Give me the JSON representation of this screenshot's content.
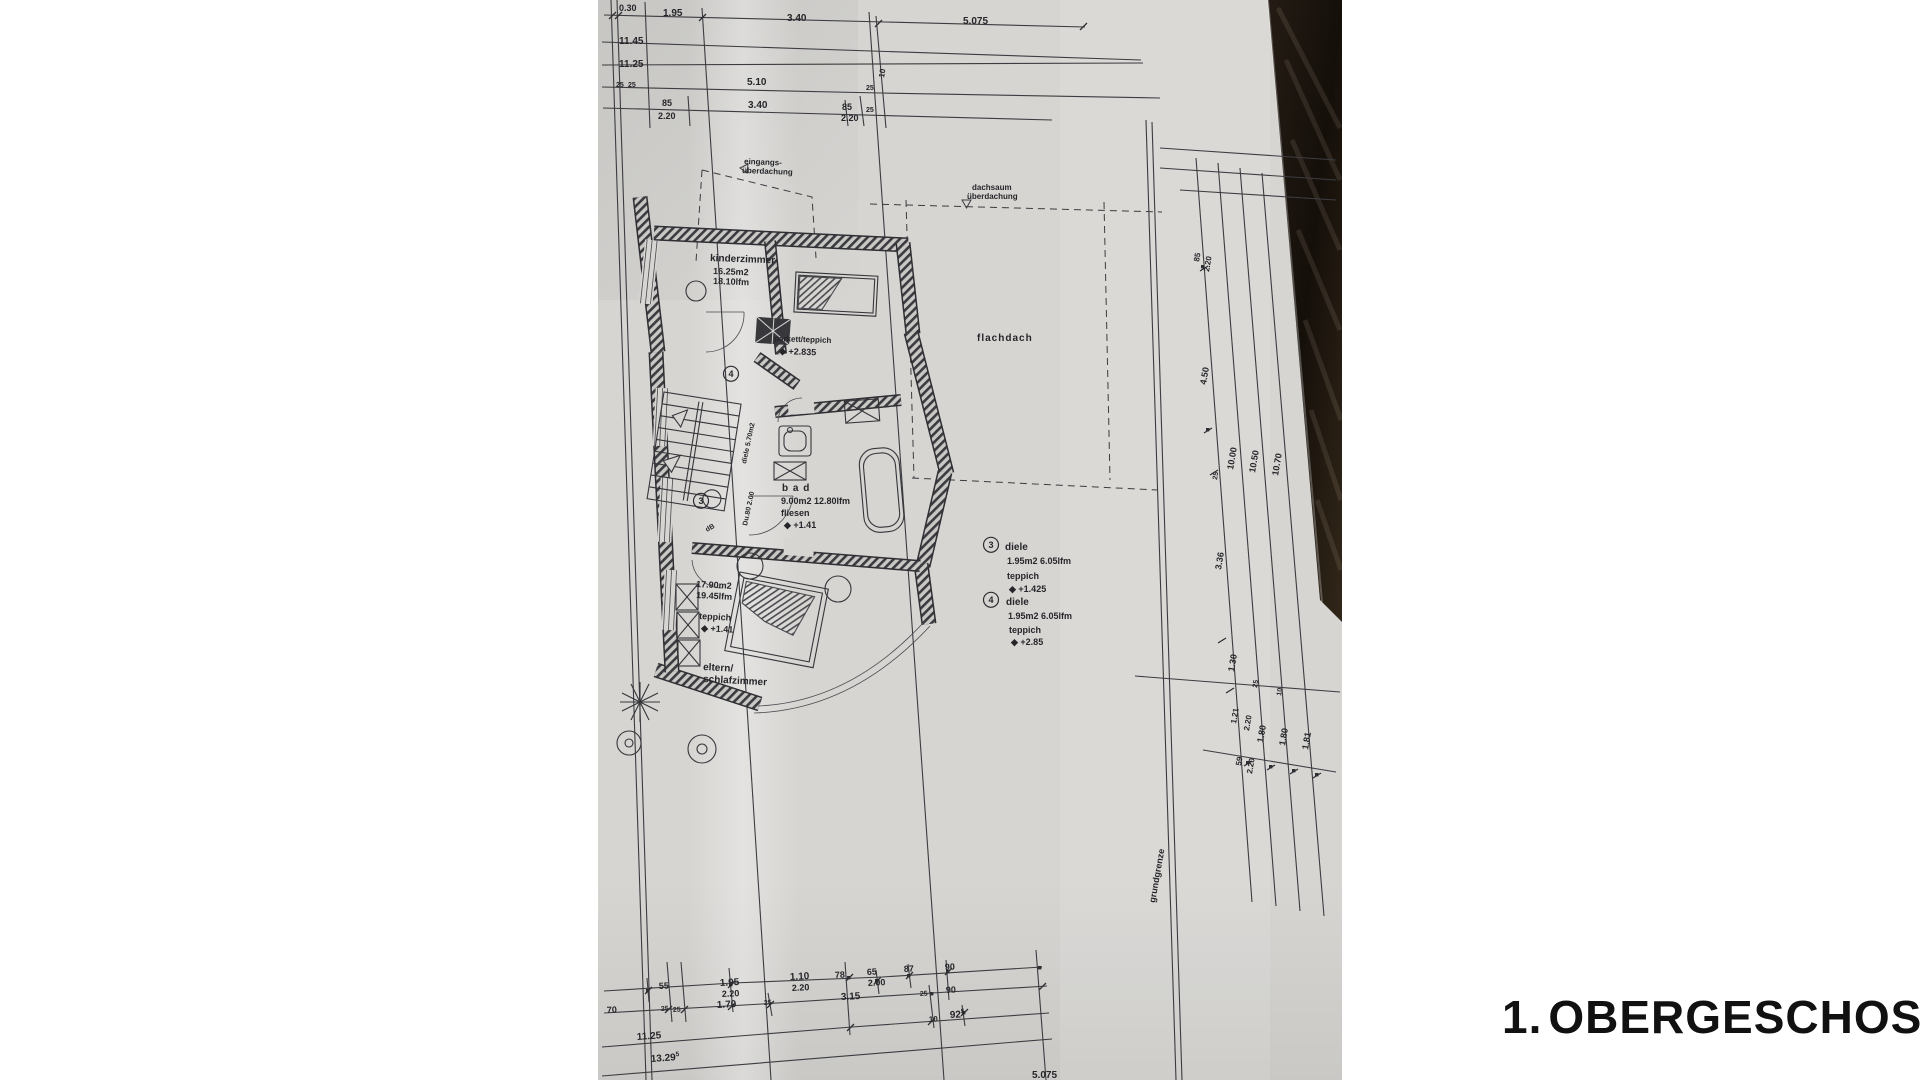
{
  "title": {
    "prefix": "1.",
    "name": "OBERGESCHOSS"
  },
  "colors": {
    "paper": "#d6d5d2",
    "line": "#3c3c41",
    "wood_dark": "#17120d",
    "wood_light": "#3a2f25",
    "title": "#111111"
  },
  "plan": {
    "labels": [
      {
        "id": "dim-030",
        "t": "0.30",
        "x": 619,
        "y": 11,
        "s": 9
      },
      {
        "id": "dim-195",
        "t": "1.95",
        "x": 663,
        "y": 16,
        "s": 10
      },
      {
        "id": "dim-340a",
        "t": "3.40",
        "x": 787,
        "y": 21,
        "s": 10
      },
      {
        "id": "dim-5075",
        "t": "5.075",
        "x": 963,
        "y": 24,
        "s": 10
      },
      {
        "id": "dim-1145",
        "t": "11.45",
        "x": 619,
        "y": 44,
        "s": 10
      },
      {
        "id": "dim-1125",
        "t": "11.25",
        "x": 619,
        "y": 67,
        "s": 10
      },
      {
        "id": "dim-510",
        "t": "5.10",
        "x": 747,
        "y": 85,
        "s": 10
      },
      {
        "id": "dim-10a",
        "t": "10",
        "x": 884,
        "y": 78,
        "s": 8,
        "r": -80
      },
      {
        "id": "dim-25a",
        "t": "25",
        "x": 866,
        "y": 90,
        "s": 7
      },
      {
        "id": "dim-25b",
        "t": "25",
        "x": 616,
        "y": 87,
        "s": 7
      },
      {
        "id": "dim-25c",
        "t": "25",
        "x": 628,
        "y": 87,
        "s": 7
      },
      {
        "id": "dim-85a",
        "t": "85",
        "x": 662,
        "y": 106,
        "s": 9
      },
      {
        "id": "dim-340b",
        "t": "3.40",
        "x": 748,
        "y": 108,
        "s": 10
      },
      {
        "id": "dim-85b",
        "t": "85",
        "x": 842,
        "y": 110,
        "s": 9
      },
      {
        "id": "dim-25d",
        "t": "25",
        "x": 866,
        "y": 112,
        "s": 7
      },
      {
        "id": "dim-220a",
        "t": "2.20",
        "x": 658,
        "y": 119,
        "s": 9
      },
      {
        "id": "dim-220b",
        "t": "2.20",
        "x": 841,
        "y": 121,
        "s": 9
      },
      {
        "id": "lbl-eingangs-1",
        "t": "eingangs-",
        "x": 744,
        "y": 164,
        "s": 8,
        "r": 2
      },
      {
        "id": "lbl-eingangs-2",
        "t": "überdachung",
        "x": 742,
        "y": 173,
        "s": 8,
        "r": 2
      },
      {
        "id": "lbl-dachsaum-1",
        "t": "dachsaum",
        "x": 972,
        "y": 190,
        "s": 8
      },
      {
        "id": "lbl-dachsaum-2",
        "t": "überdachung",
        "x": 967,
        "y": 199,
        "s": 8
      },
      {
        "id": "room-kinderzimmer",
        "t": "kinderzimmer",
        "x": 710,
        "y": 261,
        "s": 10,
        "r": 2
      },
      {
        "id": "kinder-area",
        "t": "16.25m2",
        "x": 713,
        "y": 274,
        "s": 9,
        "r": 2
      },
      {
        "id": "kinder-lfm",
        "t": "18.10lfm",
        "x": 713,
        "y": 284,
        "s": 9,
        "r": 2
      },
      {
        "id": "kinder-floor",
        "t": "parkett/teppich",
        "x": 774,
        "y": 341,
        "s": 8,
        "r": 2
      },
      {
        "id": "kinder-level",
        "t": "◆ +2.835",
        "x": 779,
        "y": 354,
        "s": 9,
        "r": 2
      },
      {
        "id": "lbl-flachdach",
        "t": "flachdach",
        "x": 977,
        "y": 341,
        "s": 10,
        "ls": 1
      },
      {
        "id": "room-bad",
        "t": "b a d",
        "x": 782,
        "y": 491,
        "s": 10,
        "ls": 1
      },
      {
        "id": "bad-area",
        "t": "9.00m2 12.80lfm",
        "x": 781,
        "y": 504,
        "s": 9
      },
      {
        "id": "bad-floor",
        "t": "fliesen",
        "x": 781,
        "y": 516,
        "s": 9
      },
      {
        "id": "bad-level",
        "t": "◆ +1.41",
        "x": 784,
        "y": 528,
        "s": 9
      },
      {
        "id": "circle-3-plan",
        "t": "3",
        "x": 701,
        "y": 504,
        "s": 9,
        "c": true
      },
      {
        "id": "circle-4-plan",
        "t": "4",
        "x": 731,
        "y": 377,
        "s": 9,
        "c": true
      },
      {
        "id": "stair-note",
        "t": "diele 5.70m2",
        "x": 746,
        "y": 464,
        "s": 7,
        "r": -78
      },
      {
        "id": "shower-note",
        "t": "Du.80 2.00",
        "x": 747,
        "y": 526,
        "s": 7,
        "r": -78
      },
      {
        "id": "door-note",
        "t": "dB",
        "x": 707,
        "y": 532,
        "s": 7,
        "r": -30
      },
      {
        "id": "circle-3-legend",
        "t": "3",
        "x": 991,
        "y": 548,
        "s": 9,
        "c": true
      },
      {
        "id": "diele3-name",
        "t": "diele",
        "x": 1005,
        "y": 550,
        "s": 10
      },
      {
        "id": "diele3-area",
        "t": "1.95m2  6.05lfm",
        "x": 1007,
        "y": 564,
        "s": 9
      },
      {
        "id": "diele3-floor",
        "t": "teppich",
        "x": 1007,
        "y": 579,
        "s": 9
      },
      {
        "id": "diele3-level",
        "t": "◆ +1.425",
        "x": 1009,
        "y": 592,
        "s": 9
      },
      {
        "id": "circle-4-legend",
        "t": "4",
        "x": 991,
        "y": 603,
        "s": 9,
        "c": true
      },
      {
        "id": "diele4-name",
        "t": "diele",
        "x": 1006,
        "y": 605,
        "s": 10
      },
      {
        "id": "diele4-area",
        "t": "1.95m2  6.05lfm",
        "x": 1008,
        "y": 619,
        "s": 9
      },
      {
        "id": "diele4-floor",
        "t": "teppich",
        "x": 1009,
        "y": 633,
        "s": 9
      },
      {
        "id": "diele4-level",
        "t": "◆ +2.85",
        "x": 1011,
        "y": 645,
        "s": 9
      },
      {
        "id": "eltern-area",
        "t": "17.90m2",
        "x": 696,
        "y": 587,
        "s": 9,
        "r": 3
      },
      {
        "id": "eltern-lfm",
        "t": "19.45lfm",
        "x": 696,
        "y": 598,
        "s": 9,
        "r": 3
      },
      {
        "id": "eltern-floor",
        "t": "teppich",
        "x": 699,
        "y": 619,
        "s": 9,
        "r": 3
      },
      {
        "id": "eltern-level",
        "t": "◆ +1.41",
        "x": 701,
        "y": 631,
        "s": 9,
        "r": 3
      },
      {
        "id": "room-eltern-1",
        "t": "eltern/",
        "x": 703,
        "y": 670,
        "s": 10,
        "r": 3
      },
      {
        "id": "room-eltern-2",
        "t": "schlafzimmer",
        "x": 703,
        "y": 682,
        "s": 10,
        "r": 3
      },
      {
        "id": "lbl-grundgrenze",
        "t": "grundgrenze",
        "x": 1155,
        "y": 903,
        "s": 9,
        "r": -80
      },
      {
        "id": "r-85",
        "t": "85",
        "x": 1199,
        "y": 262,
        "s": 8,
        "r": -80
      },
      {
        "id": "r-220a",
        "t": "2.20",
        "x": 1209,
        "y": 272,
        "s": 8,
        "r": -80
      },
      {
        "id": "r-450",
        "t": "4.50",
        "x": 1206,
        "y": 385,
        "s": 9,
        "r": -80
      },
      {
        "id": "r-1000",
        "t": "10.00",
        "x": 1233,
        "y": 470,
        "s": 9,
        "r": -80
      },
      {
        "id": "r-1050",
        "t": "10.50",
        "x": 1255,
        "y": 473,
        "s": 9,
        "r": -80
      },
      {
        "id": "r-1070",
        "t": "10.70",
        "x": 1278,
        "y": 476,
        "s": 9,
        "r": -80
      },
      {
        "id": "r-25a",
        "t": "25",
        "x": 1217,
        "y": 480,
        "s": 7,
        "r": -80
      },
      {
        "id": "r-336",
        "t": "3.36",
        "x": 1221,
        "y": 570,
        "s": 9,
        "r": -80
      },
      {
        "id": "r-130",
        "t": "1.30",
        "x": 1234,
        "y": 672,
        "s": 9,
        "r": -80
      },
      {
        "id": "r-25b",
        "t": "25",
        "x": 1257,
        "y": 688,
        "s": 7,
        "r": -80
      },
      {
        "id": "r-10",
        "t": "10",
        "x": 1281,
        "y": 696,
        "s": 7,
        "r": -80
      },
      {
        "id": "r-121",
        "t": "1.21",
        "x": 1236,
        "y": 724,
        "s": 8,
        "r": -80
      },
      {
        "id": "r-220b",
        "t": "2.20",
        "x": 1249,
        "y": 731,
        "s": 8,
        "r": -80
      },
      {
        "id": "r-180a",
        "t": "1.80",
        "x": 1263,
        "y": 743,
        "s": 9,
        "r": -80
      },
      {
        "id": "r-180b",
        "t": "1.80",
        "x": 1285,
        "y": 746,
        "s": 9,
        "r": -80
      },
      {
        "id": "r-181",
        "t": "1.81",
        "x": 1308,
        "y": 750,
        "s": 9,
        "r": -80
      },
      {
        "id": "r-59",
        "t": "59",
        "x": 1241,
        "y": 766,
        "s": 8,
        "r": -80
      },
      {
        "id": "r-220c",
        "t": "2.20",
        "x": 1252,
        "y": 774,
        "s": 8,
        "r": -80
      },
      {
        "id": "b-55",
        "t": "55",
        "x": 659,
        "y": 989,
        "s": 9,
        "r": -3
      },
      {
        "id": "b-195",
        "t": "1.95",
        "x": 720,
        "y": 986,
        "s": 10,
        "r": -3
      },
      {
        "id": "b-220a",
        "t": "2.20",
        "x": 722,
        "y": 997,
        "s": 9,
        "r": -3
      },
      {
        "id": "b-110",
        "t": "1.10",
        "x": 790,
        "y": 980,
        "s": 10,
        "r": -3
      },
      {
        "id": "b-220b",
        "t": "2.20",
        "x": 792,
        "y": 991,
        "s": 9,
        "r": -3
      },
      {
        "id": "b-78",
        "t": "78",
        "x": 835,
        "y": 978,
        "s": 9,
        "r": -3
      },
      {
        "id": "b-65",
        "t": "65",
        "x": 867,
        "y": 975,
        "s": 9,
        "r": -3
      },
      {
        "id": "b-200",
        "t": "2.00",
        "x": 868,
        "y": 986,
        "s": 9,
        "r": -3
      },
      {
        "id": "b-87",
        "t": "87",
        "x": 904,
        "y": 972,
        "s": 9,
        "r": -3
      },
      {
        "id": "b-90a",
        "t": "90",
        "x": 945,
        "y": 970,
        "s": 9,
        "r": -3
      },
      {
        "id": "b-70",
        "t": "70",
        "x": 607,
        "y": 1013,
        "s": 9,
        "r": -3
      },
      {
        "id": "b-25a",
        "t": "25",
        "x": 661,
        "y": 1011,
        "s": 7,
        "r": -3
      },
      {
        "id": "b-25b",
        "t": "25",
        "x": 673,
        "y": 1012,
        "s": 7,
        "r": -3
      },
      {
        "id": "b-170",
        "t": "1.70",
        "x": 717,
        "y": 1008,
        "s": 10,
        "r": -3
      },
      {
        "id": "b-25c",
        "t": "25",
        "x": 764,
        "y": 1005,
        "s": 7,
        "r": -3
      },
      {
        "id": "b-315",
        "t": "3.15",
        "x": 841,
        "y": 1000,
        "s": 10,
        "r": -3
      },
      {
        "id": "b-25d",
        "t": "25",
        "x": 920,
        "y": 996,
        "s": 7,
        "r": -3
      },
      {
        "id": "b-90b",
        "t": "90",
        "x": 946,
        "y": 993,
        "s": 9,
        "r": -3
      },
      {
        "id": "b-10",
        "t": "10",
        "x": 929,
        "y": 1022,
        "s": 8,
        "r": -3
      },
      {
        "id": "b-925",
        "t": "92",
        "sup": "5",
        "x": 950,
        "y": 1018,
        "s": 10,
        "r": -3
      },
      {
        "id": "b-1125",
        "t": "11.25",
        "x": 637,
        "y": 1040,
        "s": 10,
        "r": -4
      },
      {
        "id": "b-13295",
        "t": "13.29",
        "sup": "5",
        "x": 651,
        "y": 1062,
        "s": 10,
        "r": -4
      },
      {
        "id": "b-5075",
        "t": "5.075",
        "x": 1032,
        "y": 1078,
        "s": 10
      }
    ]
  }
}
